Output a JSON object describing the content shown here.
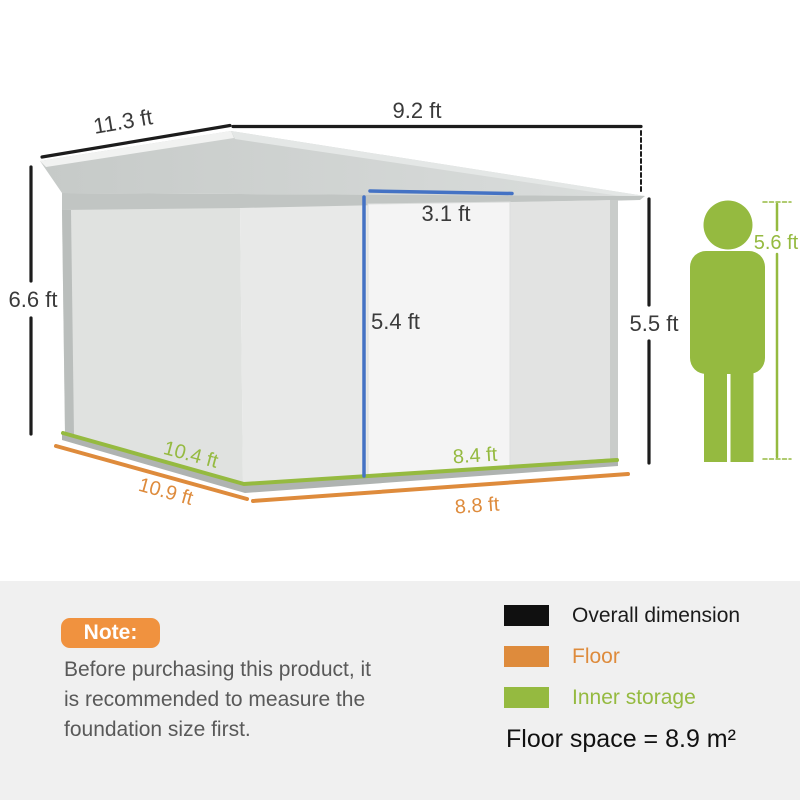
{
  "colors": {
    "overall": "#1c1c1c",
    "floor": "#de8b3c",
    "inner": "#95ba40",
    "door": "#4472c4",
    "badge": "#f0923f"
  },
  "shed": {
    "dim_roof_side": "11.3 ft",
    "dim_roof_front": "9.2 ft",
    "dim_overall_height": "6.6 ft",
    "dim_door_width": "3.1 ft",
    "dim_door_height": "5.4 ft",
    "dim_wall_height": "5.5 ft",
    "dim_inner_side": "10.4 ft",
    "dim_floor_side": "10.9 ft",
    "dim_inner_front": "8.4 ft",
    "dim_floor_front": "8.8 ft"
  },
  "person": {
    "dim_height": "5.6 ft"
  },
  "note": {
    "badge": "Note:",
    "line1": "Before purchasing this product, it",
    "line2": "is recommended to measure the",
    "line3": "foundation size first."
  },
  "legend": {
    "items": [
      {
        "label": "Overall dimension",
        "color": "#101010"
      },
      {
        "label": "Floor",
        "color": "#de8b3c"
      },
      {
        "label": "Inner storage",
        "color": "#95ba40"
      }
    ],
    "floor_space": "Floor space = 8.9 m²"
  }
}
